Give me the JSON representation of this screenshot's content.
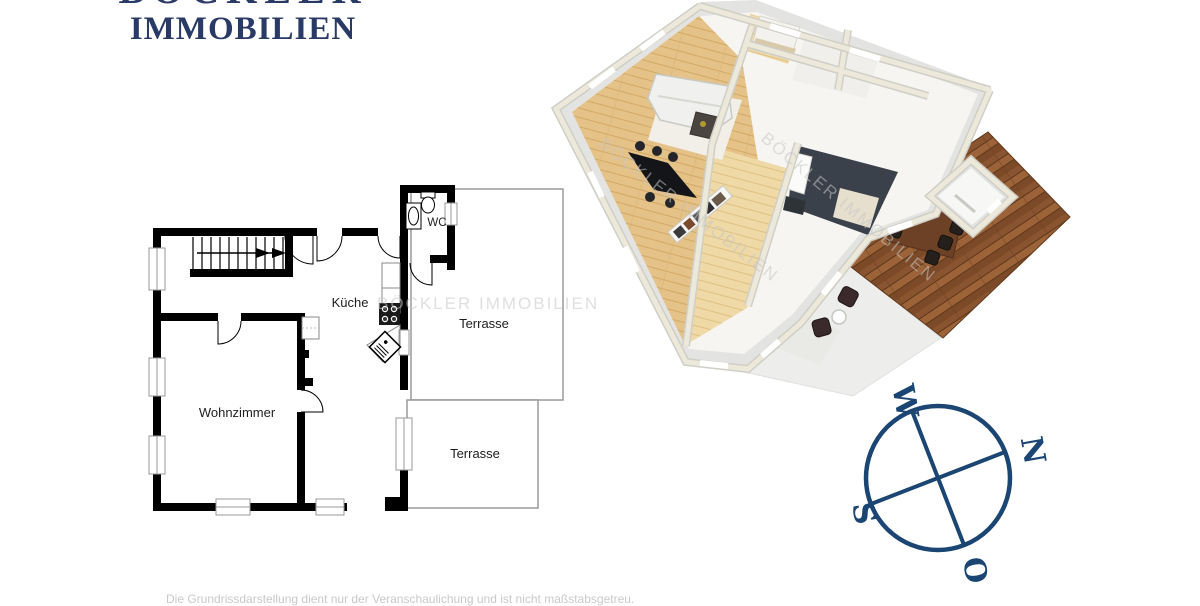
{
  "logo": {
    "line1": "BÖCKLER",
    "line2": "IMMOBILIEN"
  },
  "plan2d": {
    "labels": {
      "kueche": "Küche",
      "wc": "WC",
      "wohnzimmer": "Wohnzimmer",
      "terrasse_oben": "Terrasse",
      "terrasse_unten": "Terrasse"
    },
    "watermark": "BÖCKLER IMMOBILIEN"
  },
  "plan3d": {
    "watermark_1": "BÖCKLER IMMOBILIEN",
    "watermark_2": "BÖCKLER IMMOBILIEN"
  },
  "compass": {
    "w": "W",
    "n": "N",
    "s": "S",
    "o": "O"
  },
  "footer": {
    "disclaimer": "Die Grundrissdarstellung dient nur der Veranschaulichung und ist nicht maßstabsgetreu."
  },
  "colors": {
    "logo_navy": "#2a3a66",
    "compass_navy": "#1b4573",
    "watermark_gray": "#c6c6c6",
    "plan_wall_black": "#000000",
    "wall_cream": "#ece9da",
    "wood_floor": "#e5c288",
    "hall_floor": "#efd9a6",
    "kitchen_floor": "#3a414b",
    "deck_brown": "#8a5430",
    "terrace_gray": "#ededeb"
  }
}
